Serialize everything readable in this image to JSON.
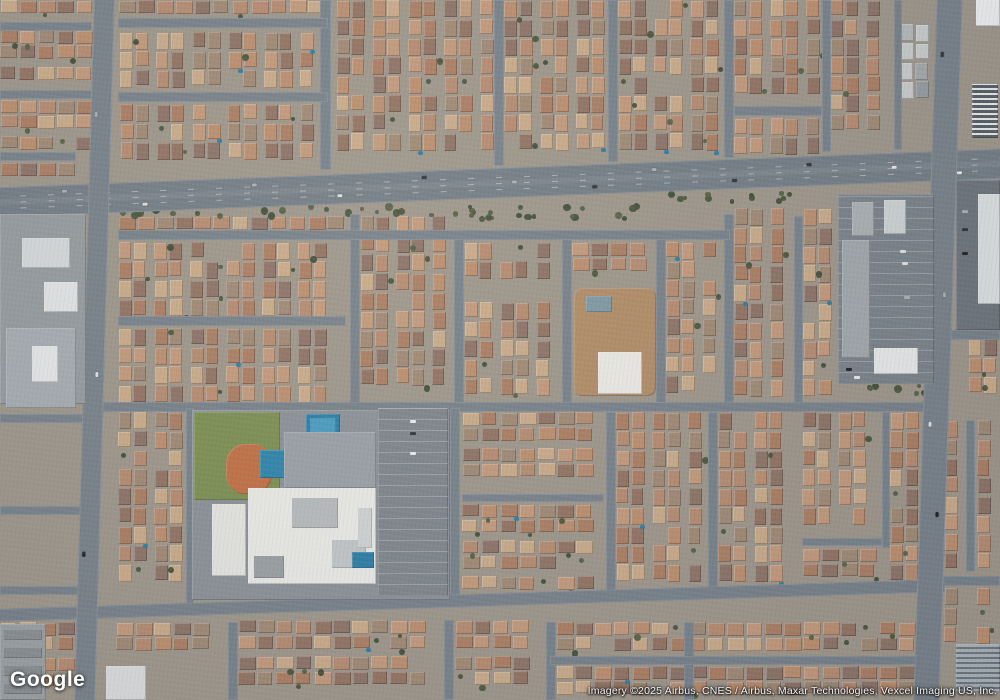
{
  "ui": {
    "logo_text": "Google",
    "attribution": "Imagery ©2025 Airbus, CNES / Airbus, Maxar Technologies, Vexcel Imaging US, Inc."
  },
  "map": {
    "colors": {
      "base": "#9e978c",
      "street": "#78828b",
      "arterial": "#747e87",
      "pool": "#2e7ea7",
      "car_colors": [
        "#e9ebed",
        "#30363b",
        "#aab2b8",
        "#1f2428",
        "#dfe2e4"
      ]
    },
    "palettes": {
      "res": [
        "#b58c72",
        "#c29a7d",
        "#aa7f65",
        "#927464",
        "#c9ab8b",
        "#a08a76",
        "#bb8f70",
        "#8d7468"
      ],
      "gray": [
        "#b6babc",
        "#a4a9ac",
        "#c9cccd",
        "#969da1"
      ],
      "tree": [
        "#46543a",
        "#526044",
        "#3e4c36"
      ]
    },
    "roads": [
      {
        "name": "main-arterial-road",
        "x": -8,
        "y": 168,
        "w": 1016,
        "h": 30,
        "rot": -2.2,
        "c": "#747e87",
        "marks": true,
        "cars": [
          [
            70,
            5
          ],
          [
            150,
            21
          ],
          [
            260,
            6
          ],
          [
            345,
            20
          ],
          [
            430,
            5
          ],
          [
            520,
            13
          ],
          [
            600,
            21
          ],
          [
            660,
            6
          ],
          [
            740,
            20
          ],
          [
            815,
            7
          ],
          [
            900,
            13
          ],
          [
            965,
            21
          ]
        ]
      },
      {
        "name": "left-vertical-road",
        "x": 84,
        "y": -8,
        "w": 21,
        "h": 716,
        "rot": 1.6,
        "c": "#79828b",
        "cars": [
          [
            120,
            4
          ],
          [
            380,
            12
          ],
          [
            560,
            4
          ]
        ]
      },
      {
        "name": "right-vertical-road",
        "x": 925,
        "y": -8,
        "w": 26,
        "h": 716,
        "rot": 1.9,
        "c": "#79828b",
        "cars": [
          [
            60,
            6
          ],
          [
            300,
            16
          ],
          [
            430,
            6
          ],
          [
            520,
            16
          ]
        ]
      }
    ],
    "streets": [
      [
        320,
        0,
        11,
        170
      ],
      [
        494,
        0,
        10,
        166
      ],
      [
        608,
        0,
        10,
        162
      ],
      [
        724,
        0,
        10,
        158
      ],
      [
        822,
        0,
        9,
        152
      ],
      [
        894,
        0,
        8,
        150
      ],
      [
        0,
        22,
        92,
        9
      ],
      [
        0,
        90,
        92,
        9
      ],
      [
        0,
        152,
        76,
        9
      ],
      [
        118,
        18,
        210,
        10
      ],
      [
        118,
        92,
        210,
        10
      ],
      [
        734,
        106,
        88,
        10
      ],
      [
        350,
        214,
        10,
        194
      ],
      [
        454,
        234,
        10,
        174
      ],
      [
        562,
        234,
        10,
        174
      ],
      [
        656,
        234,
        10,
        174
      ],
      [
        724,
        214,
        10,
        194
      ],
      [
        794,
        216,
        9,
        192
      ],
      [
        118,
        230,
        612,
        10
      ],
      [
        118,
        316,
        228,
        10
      ],
      [
        88,
        402,
        852,
        10
      ],
      [
        186,
        408,
        8,
        196
      ],
      [
        450,
        408,
        10,
        190
      ],
      [
        606,
        412,
        10,
        186
      ],
      [
        708,
        412,
        10,
        186
      ],
      [
        882,
        412,
        8,
        136
      ],
      [
        966,
        420,
        9,
        152
      ],
      [
        462,
        494,
        142,
        8
      ],
      [
        802,
        538,
        80,
        8
      ],
      [
        935,
        330,
        65,
        10
      ],
      [
        935,
        576,
        65,
        10
      ],
      [
        0,
        414,
        86,
        9
      ],
      [
        0,
        506,
        86,
        9
      ],
      [
        0,
        586,
        86,
        9
      ],
      [
        228,
        622,
        10,
        78
      ],
      [
        444,
        620,
        10,
        80
      ],
      [
        546,
        622,
        10,
        78
      ],
      [
        684,
        622,
        10,
        78
      ],
      [
        550,
        656,
        380,
        9
      ],
      [
        -5,
        594,
        950,
        13,
        -1.8
      ]
    ],
    "blocks": [
      [
        0,
        0,
        92,
        18,
        "h"
      ],
      [
        0,
        30,
        92,
        52,
        "h"
      ],
      [
        0,
        100,
        92,
        50,
        "h"
      ],
      [
        0,
        162,
        76,
        24,
        "h"
      ],
      [
        118,
        0,
        208,
        16,
        "h"
      ],
      [
        120,
        32,
        206,
        56,
        "v"
      ],
      [
        120,
        104,
        206,
        64,
        "v"
      ],
      [
        336,
        0,
        156,
        166,
        "v"
      ],
      [
        504,
        0,
        102,
        160,
        "v"
      ],
      [
        618,
        0,
        104,
        154,
        "v"
      ],
      [
        734,
        0,
        88,
        104,
        "v"
      ],
      [
        734,
        118,
        88,
        42,
        "v"
      ],
      [
        830,
        0,
        62,
        146,
        "v"
      ],
      [
        900,
        24,
        34,
        86,
        "v",
        "gray"
      ],
      [
        118,
        216,
        226,
        12,
        "h"
      ],
      [
        118,
        242,
        226,
        72,
        "v"
      ],
      [
        118,
        328,
        226,
        72,
        "v"
      ],
      [
        360,
        216,
        88,
        184,
        "v"
      ],
      [
        464,
        242,
        96,
        52,
        "v"
      ],
      [
        464,
        302,
        96,
        98,
        "v"
      ],
      [
        572,
        242,
        82,
        40,
        "h"
      ],
      [
        666,
        242,
        54,
        158,
        "v"
      ],
      [
        734,
        208,
        58,
        192,
        "v"
      ],
      [
        803,
        208,
        32,
        192,
        "v"
      ],
      [
        968,
        338,
        32,
        62,
        "v"
      ],
      [
        118,
        412,
        66,
        184,
        "v"
      ],
      [
        462,
        412,
        140,
        80,
        "h"
      ],
      [
        462,
        504,
        140,
        92,
        "h"
      ],
      [
        616,
        412,
        88,
        180,
        "v"
      ],
      [
        718,
        412,
        76,
        182,
        "v"
      ],
      [
        802,
        412,
        78,
        124,
        "v"
      ],
      [
        802,
        548,
        78,
        44,
        "h"
      ],
      [
        890,
        412,
        28,
        180,
        "v"
      ],
      [
        944,
        420,
        20,
        148,
        "v"
      ],
      [
        977,
        420,
        23,
        148,
        "v"
      ],
      [
        944,
        588,
        20,
        54,
        "v"
      ],
      [
        977,
        588,
        23,
        54,
        "v"
      ],
      [
        0,
        622,
        82,
        76,
        "h"
      ],
      [
        116,
        622,
        108,
        40,
        "h"
      ],
      [
        238,
        620,
        204,
        78,
        "h"
      ],
      [
        455,
        620,
        86,
        78,
        "h"
      ],
      [
        556,
        622,
        372,
        32,
        "h"
      ],
      [
        556,
        666,
        372,
        30,
        "h"
      ]
    ],
    "tree_clusters": [
      [
        108,
        202,
        544,
        12,
        34
      ],
      [
        652,
        190,
        280,
        10,
        16
      ],
      [
        194,
        412,
        12,
        178,
        16
      ],
      [
        196,
        486,
        88,
        10,
        9
      ],
      [
        198,
        584,
        248,
        10,
        14
      ],
      [
        0,
        196,
        88,
        10,
        8
      ],
      [
        838,
        382,
        96,
        10,
        8
      ],
      [
        450,
        210,
        180,
        8,
        10
      ]
    ],
    "landmarks": [
      {
        "name": "industrial-lot",
        "x": 0,
        "y": 214,
        "w": 86,
        "h": 190,
        "c": "#969ca0"
      },
      {
        "name": "industrial-building-a",
        "x": 22,
        "y": 238,
        "w": 48,
        "h": 30,
        "c": "#d5d9db"
      },
      {
        "name": "industrial-building-b",
        "x": 44,
        "y": 282,
        "w": 34,
        "h": 30,
        "c": "#e1e4e5"
      },
      {
        "name": "warehouse-building",
        "x": 6,
        "y": 328,
        "w": 70,
        "h": 80,
        "c": "#a6adb2",
        "sub": [
          [
            26,
            18,
            26,
            36,
            "#e4e7e8"
          ]
        ]
      },
      {
        "name": "school-grounds",
        "x": 192,
        "y": 410,
        "w": 258,
        "h": 190,
        "c": "#8b9298"
      },
      {
        "name": "school-park-grass",
        "x": 194,
        "y": 412,
        "w": 86,
        "h": 88,
        "c": "#7c9054"
      },
      {
        "name": "baseball-dirt-field",
        "x": 226,
        "y": 444,
        "w": 46,
        "h": 50,
        "c": "#c07146",
        "br": "40%"
      },
      {
        "name": "school-pool",
        "x": 306,
        "y": 414,
        "w": 34,
        "h": 24,
        "c": "#2e7ea7",
        "sub": [
          [
            4,
            4,
            26,
            16,
            "#4a9cc0"
          ]
        ]
      },
      {
        "name": "school-pool-2",
        "x": 260,
        "y": 450,
        "w": 28,
        "h": 28,
        "c": "#2f85ac"
      },
      {
        "name": "school-courtyard",
        "x": 284,
        "y": 432,
        "w": 92,
        "h": 56,
        "c": "#99a1a7"
      },
      {
        "name": "school-main-building",
        "x": 248,
        "y": 488,
        "w": 128,
        "h": 96,
        "c": "#e9eae7",
        "sub": [
          [
            44,
            10,
            46,
            30,
            "#b7bbbd"
          ],
          [
            84,
            52,
            34,
            28,
            "#c2c6c8"
          ],
          [
            6,
            68,
            30,
            22,
            "#9aa0a4"
          ],
          [
            110,
            20,
            14,
            40,
            "#cfd3d5"
          ]
        ]
      },
      {
        "name": "school-west-building",
        "x": 212,
        "y": 504,
        "w": 34,
        "h": 72,
        "c": "#e4e5e2"
      },
      {
        "name": "school-parking-lot",
        "x": 378,
        "y": 408,
        "w": 70,
        "h": 188,
        "c": "#7e868d",
        "lines": "h"
      },
      {
        "name": "school-pool-3",
        "x": 352,
        "y": 552,
        "w": 22,
        "h": 16,
        "c": "#2e7ea7"
      },
      {
        "name": "construction-dirt-lot",
        "x": 574,
        "y": 288,
        "w": 82,
        "h": 108,
        "c": "#b18d69",
        "br": "8px"
      },
      {
        "name": "construction-pool",
        "x": 586,
        "y": 296,
        "w": 26,
        "h": 16,
        "c": "#7f99a4"
      },
      {
        "name": "construction-white-building",
        "x": 598,
        "y": 352,
        "w": 44,
        "h": 42,
        "c": "#eaeae6"
      },
      {
        "name": "retail-parking-lot",
        "x": 838,
        "y": 194,
        "w": 96,
        "h": 190,
        "c": "#7b838b",
        "lines": "h"
      },
      {
        "name": "retail-strip-building",
        "x": 842,
        "y": 240,
        "w": 28,
        "h": 118,
        "c": "#a2a8ad"
      },
      {
        "name": "retail-building-b",
        "x": 884,
        "y": 200,
        "w": 22,
        "h": 34,
        "c": "#ced3d5"
      },
      {
        "name": "retail-building-c",
        "x": 852,
        "y": 202,
        "w": 22,
        "h": 34,
        "c": "#abb1b5"
      },
      {
        "name": "retail-white-building",
        "x": 874,
        "y": 348,
        "w": 44,
        "h": 26,
        "c": "#e7e9ea"
      },
      {
        "name": "corner-white-building",
        "x": 976,
        "y": 0,
        "w": 24,
        "h": 26,
        "c": "#edeff0"
      },
      {
        "name": "striped-roof-building",
        "x": 972,
        "y": 84,
        "w": 26,
        "h": 54,
        "stripes": [
          "#596067",
          "#e8eaeb"
        ]
      },
      {
        "name": "east-parking-lot",
        "x": 956,
        "y": 180,
        "w": 44,
        "h": 150,
        "c": "#6e767e"
      },
      {
        "name": "east-white-building",
        "x": 978,
        "y": 194,
        "w": 22,
        "h": 110,
        "c": "#dde1e3"
      },
      {
        "name": "apartment-buildings",
        "x": 0,
        "y": 624,
        "w": 46,
        "h": 76,
        "c": "#9ba1a4",
        "sub": [
          [
            4,
            6,
            38,
            10,
            "#8a9093"
          ],
          [
            4,
            24,
            38,
            10,
            "#8a9093"
          ],
          [
            4,
            42,
            38,
            10,
            "#8a9093"
          ],
          [
            4,
            60,
            38,
            10,
            "#8a9093"
          ]
        ]
      },
      {
        "name": "light-building-sw",
        "x": 106,
        "y": 666,
        "w": 40,
        "h": 34,
        "c": "#dadcdd"
      },
      {
        "name": "rv-storage-lot",
        "x": 956,
        "y": 644,
        "w": 44,
        "h": 48,
        "stripes": [
          "#aab3ba",
          "#6e7880"
        ]
      }
    ]
  }
}
